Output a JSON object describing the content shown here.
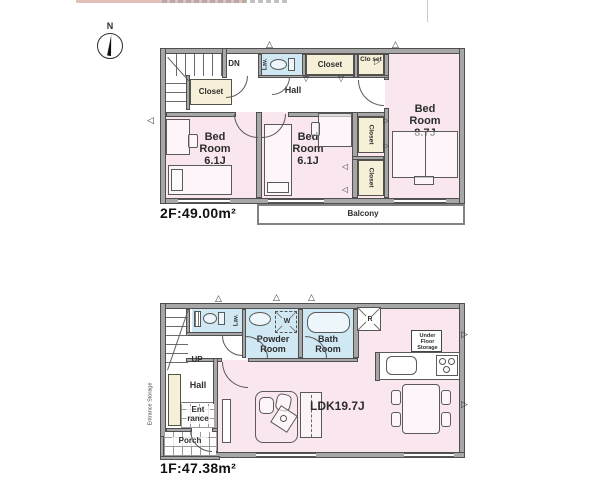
{
  "colors": {
    "wall": "#a7a7a7",
    "wall_edge": "#4f4f4f",
    "bedroom_pink": "#f9e6ef",
    "closet_cream": "#f6f0d8",
    "wet_area_blue": "#cfe8f4",
    "top_bar_pink": "#e3bfb9"
  },
  "compass": {
    "north_label": "N"
  },
  "icons": {
    "tri_up": "△",
    "tri_down": "▽",
    "tri_left": "◁",
    "tri_right": "▷"
  },
  "floor2": {
    "area_label": "2F:49.00m²",
    "down_label": "DN",
    "hall_label": "Hall",
    "lav_label": "Lav.",
    "stair_closet_label": "Closet",
    "hall_closet_label": "Closet",
    "corner_closet_label": "Clo set",
    "closet_a_label": "Closet",
    "closet_b_label": "Closet",
    "bedroom1_name": "Bed Room",
    "bedroom1_size": "6.1J",
    "bedroom2_name": "Bed Room",
    "bedroom2_size": "6.1J",
    "bedroom3_name": "Bed Room",
    "bedroom3_size": "8.7J",
    "balcony_label": "Balcony"
  },
  "floor1": {
    "area_label": "1F:47.38m²",
    "up_label": "UP",
    "hall_label": "Hall",
    "lav_label": "Lav.",
    "powder_label": "Powder Room",
    "washer_label": "W",
    "bath_label": "Bath Room",
    "fridge_label": "R",
    "under_floor_label": "Under Floor Storage",
    "entrance_storage_label": "Entrance Storage",
    "entrance_label": "Ent rance",
    "porch_label": "Porch",
    "ldk_label": "LDK19.7J"
  }
}
